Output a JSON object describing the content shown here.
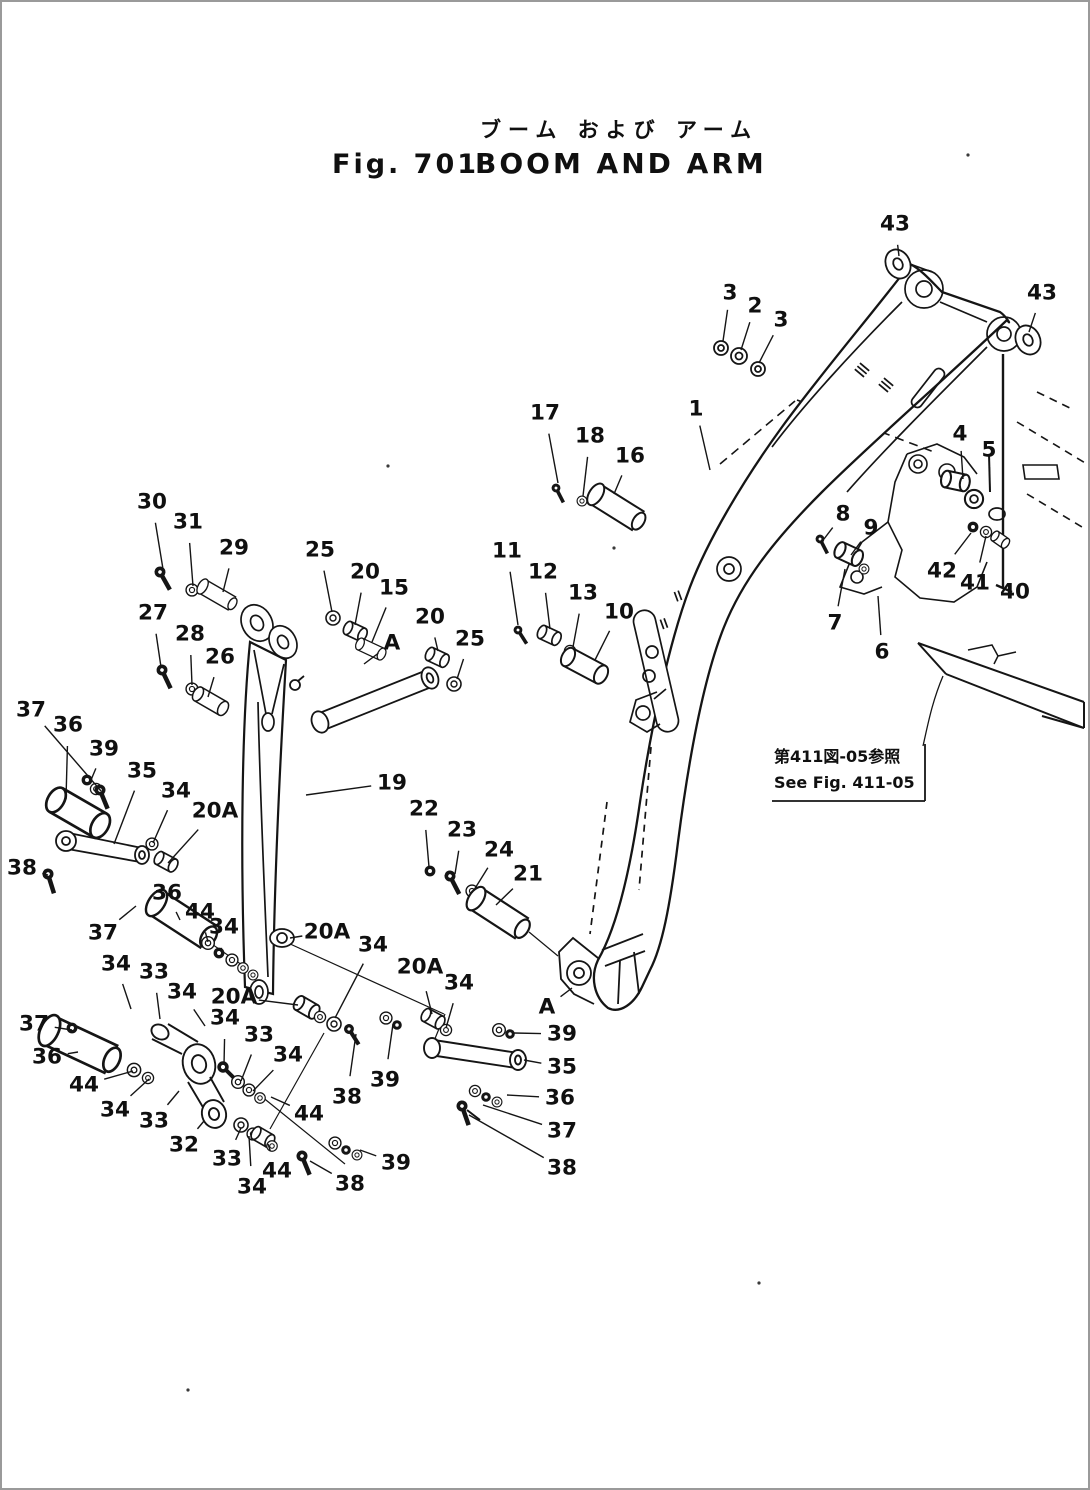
{
  "page": {
    "background": "#ffffff",
    "ink": "#151515",
    "border_color": "#9a9a9a"
  },
  "header": {
    "title_ja": "ブーム および アーム",
    "fig_label": "Fig. 701",
    "title_en": "BOOM AND ARM"
  },
  "note": {
    "ja": "第411図-05参照",
    "en": "See Fig. 411-05"
  },
  "callouts": [
    {
      "t": "43",
      "x": 893,
      "y": 222,
      "tx": 897,
      "ty": 254
    },
    {
      "t": "3",
      "x": 728,
      "y": 291,
      "tx": 721,
      "ty": 339
    },
    {
      "t": "2",
      "x": 753,
      "y": 304,
      "tx": 739,
      "ty": 348
    },
    {
      "t": "3",
      "x": 779,
      "y": 318,
      "tx": 757,
      "ty": 361
    },
    {
      "t": "43",
      "x": 1040,
      "y": 291,
      "tx": 1027,
      "ty": 330
    },
    {
      "t": "1",
      "x": 694,
      "y": 407,
      "tx": 708,
      "ty": 468
    },
    {
      "t": "17",
      "x": 543,
      "y": 411,
      "tx": 556,
      "ty": 481
    },
    {
      "t": "18",
      "x": 588,
      "y": 434,
      "tx": 581,
      "ty": 494
    },
    {
      "t": "16",
      "x": 628,
      "y": 454,
      "tx": 612,
      "ty": 492
    },
    {
      "t": "4",
      "x": 958,
      "y": 432,
      "tx": 961,
      "ty": 477
    },
    {
      "t": "5",
      "x": 987,
      "y": 448,
      "tx": 988,
      "ty": 488
    },
    {
      "t": "8",
      "x": 841,
      "y": 512,
      "tx": 822,
      "ty": 537
    },
    {
      "t": "9",
      "x": 869,
      "y": 526,
      "tx": 849,
      "ty": 553
    },
    {
      "t": "42",
      "x": 940,
      "y": 569,
      "tx": 969,
      "ty": 531
    },
    {
      "t": "41",
      "x": 973,
      "y": 581,
      "tx": 984,
      "ty": 534
    },
    {
      "t": "40",
      "x": 1013,
      "y": 590,
      "tx": 1003,
      "ty": 584
    },
    {
      "t": "7",
      "x": 833,
      "y": 621,
      "tx": 843,
      "ty": 567
    },
    {
      "t": "6",
      "x": 880,
      "y": 650,
      "tx": 876,
      "ty": 594
    },
    {
      "t": "30",
      "x": 150,
      "y": 500,
      "tx": 161,
      "ty": 567
    },
    {
      "t": "31",
      "x": 186,
      "y": 520,
      "tx": 191,
      "ty": 584
    },
    {
      "t": "29",
      "x": 232,
      "y": 546,
      "tx": 221,
      "ty": 590
    },
    {
      "t": "25",
      "x": 318,
      "y": 548,
      "tx": 330,
      "ty": 610
    },
    {
      "t": "20",
      "x": 363,
      "y": 570,
      "tx": 353,
      "ty": 623
    },
    {
      "t": "15",
      "x": 392,
      "y": 586,
      "tx": 370,
      "ty": 640
    },
    {
      "t": "20",
      "x": 428,
      "y": 615,
      "tx": 436,
      "ty": 649
    },
    {
      "t": "25",
      "x": 468,
      "y": 637,
      "tx": 455,
      "ty": 677
    },
    {
      "t": "11",
      "x": 505,
      "y": 549,
      "tx": 516,
      "ty": 623
    },
    {
      "t": "12",
      "x": 541,
      "y": 570,
      "tx": 548,
      "ty": 627
    },
    {
      "t": "13",
      "x": 581,
      "y": 591,
      "tx": 571,
      "ty": 645
    },
    {
      "t": "10",
      "x": 617,
      "y": 610,
      "tx": 593,
      "ty": 658
    },
    {
      "t": "27",
      "x": 151,
      "y": 611,
      "tx": 159,
      "ty": 665
    },
    {
      "t": "28",
      "x": 188,
      "y": 632,
      "tx": 190,
      "ty": 683
    },
    {
      "t": "26",
      "x": 218,
      "y": 655,
      "tx": 206,
      "ty": 695
    },
    {
      "t": "A",
      "x": 390,
      "y": 641,
      "tx": 362,
      "ty": 662
    },
    {
      "t": "19",
      "x": 390,
      "y": 781,
      "tx": 304,
      "ty": 793
    },
    {
      "t": "22",
      "x": 422,
      "y": 807,
      "tx": 427,
      "ty": 865
    },
    {
      "t": "23",
      "x": 460,
      "y": 828,
      "tx": 453,
      "ty": 872
    },
    {
      "t": "24",
      "x": 497,
      "y": 848,
      "tx": 472,
      "ty": 888
    },
    {
      "t": "21",
      "x": 526,
      "y": 872,
      "tx": 494,
      "ty": 903
    },
    {
      "t": "37",
      "x": 29,
      "y": 708,
      "tx": 99,
      "ty": 789
    },
    {
      "t": "36",
      "x": 66,
      "y": 723,
      "tx": 64,
      "ty": 797
    },
    {
      "t": "39",
      "x": 102,
      "y": 747,
      "tx": 89,
      "ty": 778
    },
    {
      "t": "35",
      "x": 140,
      "y": 769,
      "tx": 112,
      "ty": 842
    },
    {
      "t": "34",
      "x": 174,
      "y": 789,
      "tx": 151,
      "ty": 841
    },
    {
      "t": "20A",
      "x": 213,
      "y": 809,
      "tx": 166,
      "ty": 861
    },
    {
      "t": "38",
      "x": 20,
      "y": 866,
      "tx": 46,
      "ty": 873
    },
    {
      "t": "37",
      "x": 101,
      "y": 931,
      "tx": 134,
      "ty": 904
    },
    {
      "t": "36",
      "x": 165,
      "y": 891,
      "tx": 178,
      "ty": 918
    },
    {
      "t": "44",
      "x": 198,
      "y": 910,
      "tx": 206,
      "ty": 940
    },
    {
      "t": "34",
      "x": 222,
      "y": 925,
      "tx": 219,
      "ty": 950
    },
    {
      "t": "20A",
      "x": 325,
      "y": 930,
      "tx": 288,
      "ty": 936
    },
    {
      "t": "34",
      "x": 371,
      "y": 943,
      "tx": 333,
      "ty": 1016
    },
    {
      "t": "39",
      "x": 383,
      "y": 1078,
      "tx": 391,
      "ty": 1022
    },
    {
      "t": "38",
      "x": 345,
      "y": 1095,
      "tx": 354,
      "ty": 1032
    },
    {
      "t": "34",
      "x": 114,
      "y": 962,
      "tx": 129,
      "ty": 1007
    },
    {
      "t": "33",
      "x": 152,
      "y": 970,
      "tx": 158,
      "ty": 1017
    },
    {
      "t": "34",
      "x": 180,
      "y": 990,
      "tx": 203,
      "ty": 1024
    },
    {
      "t": "20A",
      "x": 232,
      "y": 995,
      "tx": 296,
      "ty": 1003
    },
    {
      "t": "34",
      "x": 223,
      "y": 1016,
      "tx": 222,
      "ty": 1063
    },
    {
      "t": "33",
      "x": 257,
      "y": 1033,
      "tx": 239,
      "ty": 1079
    },
    {
      "t": "34",
      "x": 286,
      "y": 1053,
      "tx": 251,
      "ty": 1089
    },
    {
      "t": "20A",
      "x": 418,
      "y": 965,
      "tx": 430,
      "ty": 1012
    },
    {
      "t": "34",
      "x": 457,
      "y": 981,
      "tx": 444,
      "ty": 1026
    },
    {
      "t": "A",
      "x": 545,
      "y": 1005,
      "tx": 570,
      "ty": 986
    },
    {
      "t": "39",
      "x": 560,
      "y": 1032,
      "tx": 512,
      "ty": 1031
    },
    {
      "t": "35",
      "x": 560,
      "y": 1065,
      "tx": 522,
      "ty": 1058
    },
    {
      "t": "36",
      "x": 558,
      "y": 1096,
      "tx": 505,
      "ty": 1093
    },
    {
      "t": "37",
      "x": 560,
      "y": 1129,
      "tx": 481,
      "ty": 1103
    },
    {
      "t": "38",
      "x": 560,
      "y": 1166,
      "tx": 467,
      "ty": 1113
    },
    {
      "t": "37",
      "x": 32,
      "y": 1022,
      "tx": 70,
      "ty": 1028
    },
    {
      "t": "36",
      "x": 45,
      "y": 1055,
      "tx": 76,
      "ty": 1050
    },
    {
      "t": "44",
      "x": 82,
      "y": 1083,
      "tx": 131,
      "ty": 1069
    },
    {
      "t": "34",
      "x": 113,
      "y": 1108,
      "tx": 147,
      "ty": 1077
    },
    {
      "t": "33",
      "x": 152,
      "y": 1119,
      "tx": 177,
      "ty": 1089
    },
    {
      "t": "32",
      "x": 182,
      "y": 1143,
      "tx": 202,
      "ty": 1119
    },
    {
      "t": "44",
      "x": 307,
      "y": 1112,
      "tx": 269,
      "ty": 1095
    },
    {
      "t": "33",
      "x": 225,
      "y": 1157,
      "tx": 239,
      "ty": 1126
    },
    {
      "t": "44",
      "x": 275,
      "y": 1169,
      "tx": 266,
      "ty": 1142
    },
    {
      "t": "34",
      "x": 250,
      "y": 1185,
      "tx": 247,
      "ty": 1134
    },
    {
      "t": "38",
      "x": 348,
      "y": 1182,
      "tx": 308,
      "ty": 1159
    },
    {
      "t": "39",
      "x": 394,
      "y": 1161,
      "tx": 358,
      "ty": 1148
    }
  ]
}
